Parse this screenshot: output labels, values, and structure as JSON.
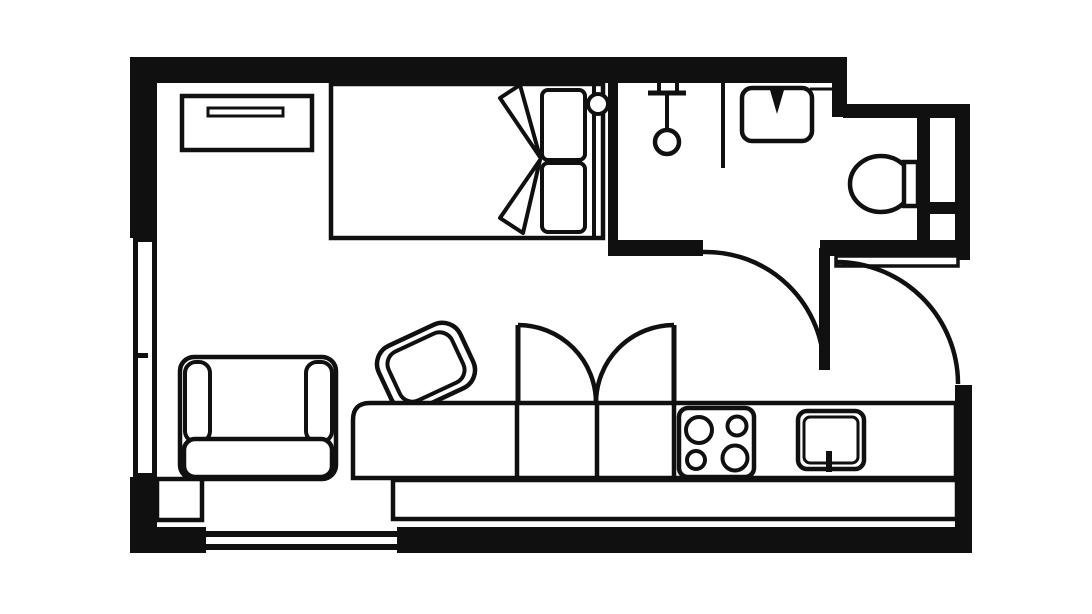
{
  "page": {
    "background": "#ffffff"
  },
  "plan": {
    "type": "studio-apartment-floor-plan",
    "svg_title": "Studio apartment floor plan",
    "line_color": "#101010",
    "background": "#ffffff",
    "rooms": [
      {
        "name": "living-area",
        "fixtures": [
          "dresser",
          "double-bed",
          "pillows",
          "blanket-fold",
          "wall-lamp",
          "armchair",
          "dining-chair",
          "cabinet-doors",
          "kitchen-counter",
          "stove-top",
          "kitchen-sink",
          "counter-front-panel"
        ]
      },
      {
        "name": "bathroom",
        "fixtures": [
          "shower-head",
          "shower-partition",
          "bathroom-sink",
          "toilet"
        ]
      },
      {
        "name": "entry-vestibule",
        "fixtures": []
      }
    ],
    "doors": [
      {
        "name": "bathroom-door",
        "swing": "quarter-arc"
      },
      {
        "name": "entry-door",
        "swing": "quarter-arc"
      }
    ],
    "windows": [
      {
        "name": "left-window"
      },
      {
        "name": "bottom-window"
      }
    ]
  }
}
